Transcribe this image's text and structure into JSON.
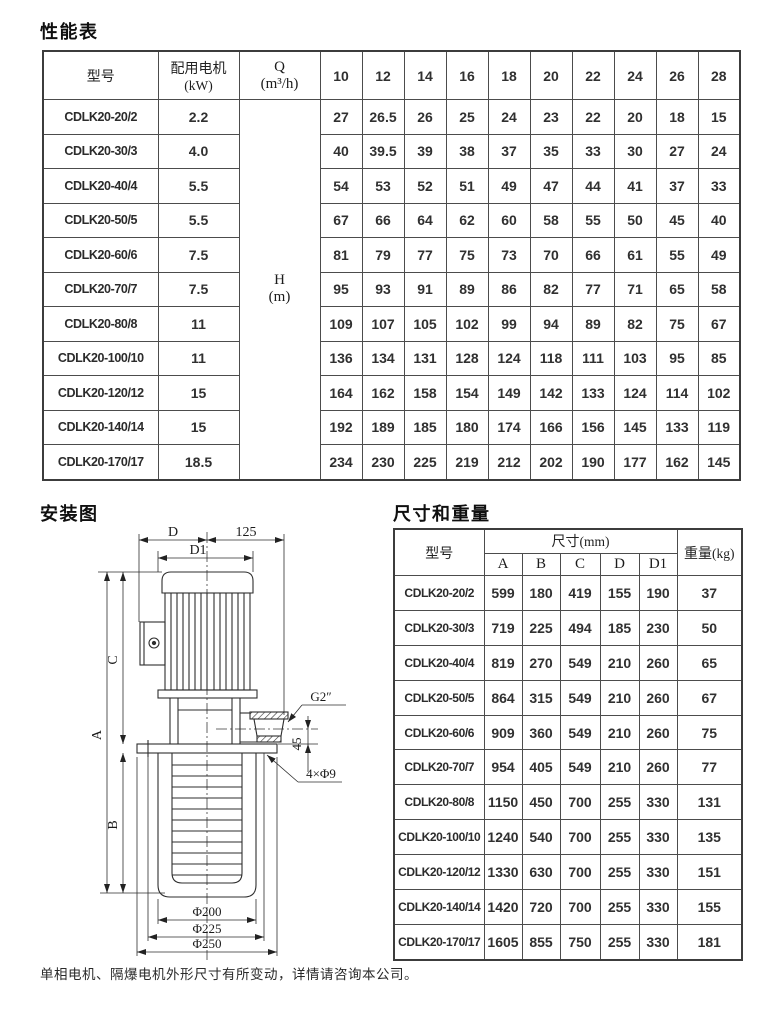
{
  "performance": {
    "title": "性能表",
    "col_model": "型号",
    "motor_line1": "配用电机",
    "motor_line2": "(kW)",
    "q_label": "Q",
    "q_unit": "(m³/h)",
    "h_label": "H",
    "h_unit": "(m)",
    "flow_values": [
      "10",
      "12",
      "14",
      "16",
      "18",
      "20",
      "22",
      "24",
      "26",
      "28"
    ],
    "rows": [
      {
        "model": "CDLK20-20/2",
        "power": "2.2",
        "heads": [
          "27",
          "26.5",
          "26",
          "25",
          "24",
          "23",
          "22",
          "20",
          "18",
          "15"
        ]
      },
      {
        "model": "CDLK20-30/3",
        "power": "4.0",
        "heads": [
          "40",
          "39.5",
          "39",
          "38",
          "37",
          "35",
          "33",
          "30",
          "27",
          "24"
        ]
      },
      {
        "model": "CDLK20-40/4",
        "power": "5.5",
        "heads": [
          "54",
          "53",
          "52",
          "51",
          "49",
          "47",
          "44",
          "41",
          "37",
          "33"
        ]
      },
      {
        "model": "CDLK20-50/5",
        "power": "5.5",
        "heads": [
          "67",
          "66",
          "64",
          "62",
          "60",
          "58",
          "55",
          "50",
          "45",
          "40"
        ]
      },
      {
        "model": "CDLK20-60/6",
        "power": "7.5",
        "heads": [
          "81",
          "79",
          "77",
          "75",
          "73",
          "70",
          "66",
          "61",
          "55",
          "49"
        ]
      },
      {
        "model": "CDLK20-70/7",
        "power": "7.5",
        "heads": [
          "95",
          "93",
          "91",
          "89",
          "86",
          "82",
          "77",
          "71",
          "65",
          "58"
        ]
      },
      {
        "model": "CDLK20-80/8",
        "power": "11",
        "heads": [
          "109",
          "107",
          "105",
          "102",
          "99",
          "94",
          "89",
          "82",
          "75",
          "67"
        ]
      },
      {
        "model": "CDLK20-100/10",
        "power": "11",
        "heads": [
          "136",
          "134",
          "131",
          "128",
          "124",
          "118",
          "111",
          "103",
          "95",
          "85"
        ]
      },
      {
        "model": "CDLK20-120/12",
        "power": "15",
        "heads": [
          "164",
          "162",
          "158",
          "154",
          "149",
          "142",
          "133",
          "124",
          "114",
          "102"
        ]
      },
      {
        "model": "CDLK20-140/14",
        "power": "15",
        "heads": [
          "192",
          "189",
          "185",
          "180",
          "174",
          "166",
          "156",
          "145",
          "133",
          "119"
        ]
      },
      {
        "model": "CDLK20-170/17",
        "power": "18.5",
        "heads": [
          "234",
          "230",
          "225",
          "219",
          "212",
          "202",
          "190",
          "177",
          "162",
          "145"
        ]
      }
    ]
  },
  "installation": {
    "title": "安装图",
    "labels": {
      "d": "D",
      "d1": "D1",
      "top_offset": "125",
      "a": "A",
      "b": "B",
      "c": "C",
      "port": "G2″",
      "port_height": "45",
      "holes": "4×Φ9",
      "dia1": "Φ200",
      "dia2": "Φ225",
      "dia3": "Φ250"
    }
  },
  "dimensions": {
    "title": "尺寸和重量",
    "col_model": "型号",
    "col_size_cn": "尺寸",
    "col_size_unit": "(mm)",
    "col_weight_cn": "重量",
    "col_weight_unit": "(kg)",
    "size_cols": [
      "A",
      "B",
      "C",
      "D",
      "D1"
    ],
    "rows": [
      {
        "model": "CDLK20-20/2",
        "values": [
          "599",
          "180",
          "419",
          "155",
          "190"
        ],
        "weight": "37"
      },
      {
        "model": "CDLK20-30/3",
        "values": [
          "719",
          "225",
          "494",
          "185",
          "230"
        ],
        "weight": "50"
      },
      {
        "model": "CDLK20-40/4",
        "values": [
          "819",
          "270",
          "549",
          "210",
          "260"
        ],
        "weight": "65"
      },
      {
        "model": "CDLK20-50/5",
        "values": [
          "864",
          "315",
          "549",
          "210",
          "260"
        ],
        "weight": "67"
      },
      {
        "model": "CDLK20-60/6",
        "values": [
          "909",
          "360",
          "549",
          "210",
          "260"
        ],
        "weight": "75"
      },
      {
        "model": "CDLK20-70/7",
        "values": [
          "954",
          "405",
          "549",
          "210",
          "260"
        ],
        "weight": "77"
      },
      {
        "model": "CDLK20-80/8",
        "values": [
          "1150",
          "450",
          "700",
          "255",
          "330"
        ],
        "weight": "131"
      },
      {
        "model": "CDLK20-100/10",
        "values": [
          "1240",
          "540",
          "700",
          "255",
          "330"
        ],
        "weight": "135"
      },
      {
        "model": "CDLK20-120/12",
        "values": [
          "1330",
          "630",
          "700",
          "255",
          "330"
        ],
        "weight": "151"
      },
      {
        "model": "CDLK20-140/14",
        "values": [
          "1420",
          "720",
          "700",
          "255",
          "330"
        ],
        "weight": "155"
      },
      {
        "model": "CDLK20-170/17",
        "values": [
          "1605",
          "855",
          "750",
          "255",
          "330"
        ],
        "weight": "181"
      }
    ]
  },
  "footer": {
    "note": "单相电机、隔爆电机外形尺寸有所变动，详情请咨询本公司。"
  }
}
